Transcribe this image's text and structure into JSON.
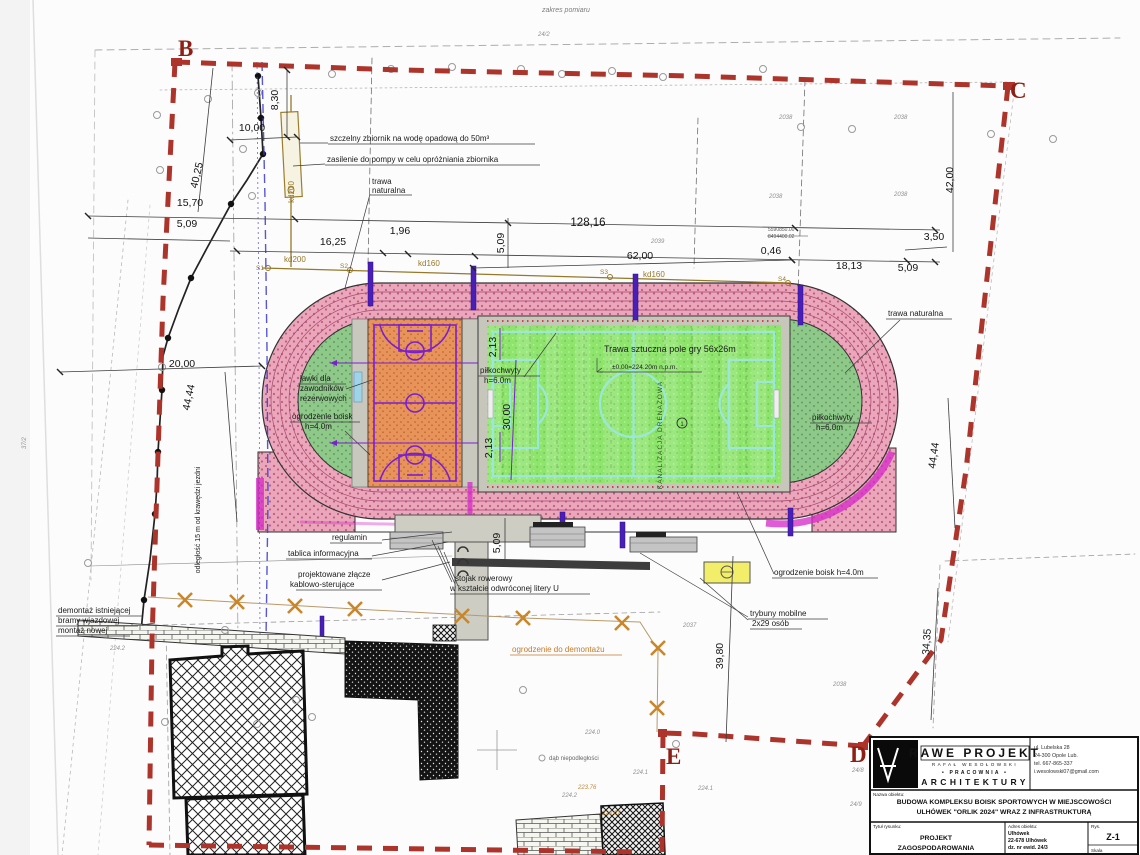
{
  "corners": {
    "b": "B",
    "c": "C",
    "d": "D",
    "e": "E"
  },
  "top": {
    "zakres": "zakres pomiaru",
    "parcel": "24/2"
  },
  "dims": {
    "d830": "8,30",
    "d1000": "10,00",
    "d4025": "40,25",
    "d1570": "15,70",
    "d509a": "5,09",
    "d1625": "16,25",
    "d196": "1,96",
    "d509b": "5,09",
    "d12816": "128,16",
    "d6200": "62,00",
    "d046": "0,46",
    "d1813": "18,13",
    "d509c": "5,09",
    "d350": "3,50",
    "d4200": "42,00",
    "d2000": "20,00",
    "d4444l": "44,44",
    "d4444r": "44,44",
    "d213a": "2,13",
    "d3000": "30,00",
    "d213b": "2,13",
    "d509d": "5,09",
    "d3980": "39,80",
    "d3435": "34,35"
  },
  "pipes": {
    "kd200v": "kd200",
    "kd200h": "kd200",
    "kd160a": "kd160",
    "kd160b": "kd160",
    "s1": "S1",
    "s2": "S2",
    "s3": "S3",
    "s4": "S4"
  },
  "callouts": {
    "zbiornik": "szczelny zbiornik na wodę opadową do 50m³",
    "zasilenie": "zasilenie do pompy w celu opróżniania zbiornika",
    "trawa_top1": "trawa",
    "trawa_top2": "naturalna",
    "trawa_right": "trawa naturalna",
    "lawki1": "ławki dla",
    "lawki2": "zawodników",
    "lawki3": "rezerwowych",
    "ogr_left1": "ogrodzenie boisk",
    "ogr_left2": "h=4.0m",
    "pilk_l1": "piłkochwyty",
    "pilk_l2": "h=6.0m",
    "pilk_r1": "piłkochwyty",
    "pilk_r2": "h=6.0m",
    "regulamin": "regulamin",
    "tablica": "tablica informacyjna",
    "zlacze1": "projektowane złącze",
    "zlacze2": "kablowo-sterujące",
    "stojak1": "stojak rowerowy",
    "stojak2": "w kształcie odwróconej litery U",
    "ogr_right": "ogrodzenie boisk h=4.0m",
    "tryb1": "trybuny mobilne",
    "tryb2": "2x29 osób",
    "ogr_dem": "ogrodzenie do demontażu",
    "dem1": "demontaż istniejącej",
    "dem2": "bramy wjazdowej",
    "dem3": "montaż nowej",
    "odleglosc": "odległość 15 m od krawędzi jezdni",
    "dab": "dąb niepodległości"
  },
  "field": {
    "title": "Trawa sztuczna pole gry 56x26m",
    "elevation": "±0.00=224.20m n.p.m.",
    "drain": "KANALIZACJA DRENAŻOWA",
    "marker": "1"
  },
  "coords": {
    "n": "5590850.00",
    "e2": "8494400.02"
  },
  "parcels": {
    "a": "2038",
    "b": "2038",
    "c": "2038",
    "d": "2038",
    "e": "2039",
    "f": "2037",
    "g": "2038",
    "h": "224.0",
    "i": "224.1",
    "j": "224.1",
    "k": "224.2",
    "l": "224.2",
    "m": "37/2",
    "n": "24/8",
    "o": "24/9",
    "p": "223.76",
    "q": "224.07"
  },
  "title_block": {
    "company1": "RAWE PROJEKT",
    "company2": "RAFAŁ WESOŁOWSKI",
    "company3": "• PRACOWNIA •",
    "company4": "ARCHITEKTURY",
    "addr1": "ul. Lubelska 28",
    "addr2": "24-300 Opole Lub.",
    "addr3": "tel. 667-865-337",
    "addr4": "i.wesolowski07@gmail.com",
    "nazwa_label": "Nazwa obiektu:",
    "nazwa1": "BUDOWA KOMPLEKSU BOISK SPORTOWYCH W MIEJSCOWOŚCI",
    "nazwa2": "ULHÓWEK \"ORLIK 2024\" WRAZ Z INFRASTRUKTURĄ",
    "tytul_label": "Tytuł rysunku:",
    "tytul1": "PROJEKT",
    "tytul2": "ZAGOSPODAROWANIA",
    "adres_label": "Adres obiektu:",
    "adres1": "Ulhówek",
    "adres2": "22-678 Ulhówek",
    "adres3": "dz. nr ewid. 24/3",
    "rys_label": "Rys.",
    "rys_value": "Z-1",
    "skala_label": "Skala"
  }
}
